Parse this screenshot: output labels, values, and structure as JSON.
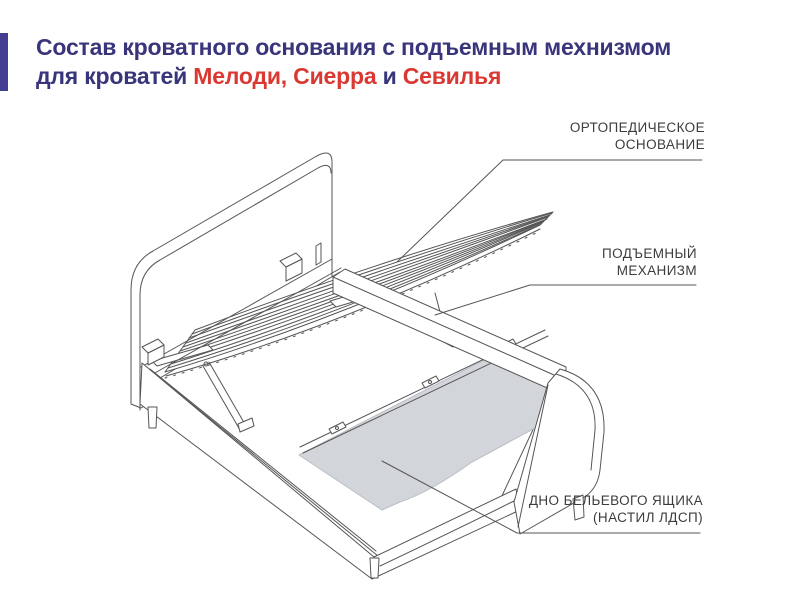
{
  "title": {
    "line1": "Состав кроватного основания с подъемным мехнизмом",
    "line2": {
      "prefix": "для кроватей ",
      "models": "Мелоди, Сиерра",
      "conjunction": " и ",
      "model2": "Севилья"
    }
  },
  "callouts": {
    "orthopedic_base": {
      "line1": "ОРТОПЕДИЧЕСКОЕ",
      "line2": "ОСНОВАНИЕ"
    },
    "lift_mechanism": {
      "line1": "ПОДЪЕМНЫЙ",
      "line2": "МЕХАНИЗМ"
    },
    "drawer_bottom": {
      "line1": "ДНО БЕЛЬЕВОГО ЯЩИКА",
      "line2": "(НАСТИЛ ЛДСП)"
    }
  },
  "colors": {
    "accent_bar": "#443e92",
    "title_text": "#39357b",
    "title_highlight": "#da3832",
    "callout_text": "#3c3c3c",
    "line_art": "#555555",
    "drawer_panel_fill": "#d2d6da"
  }
}
